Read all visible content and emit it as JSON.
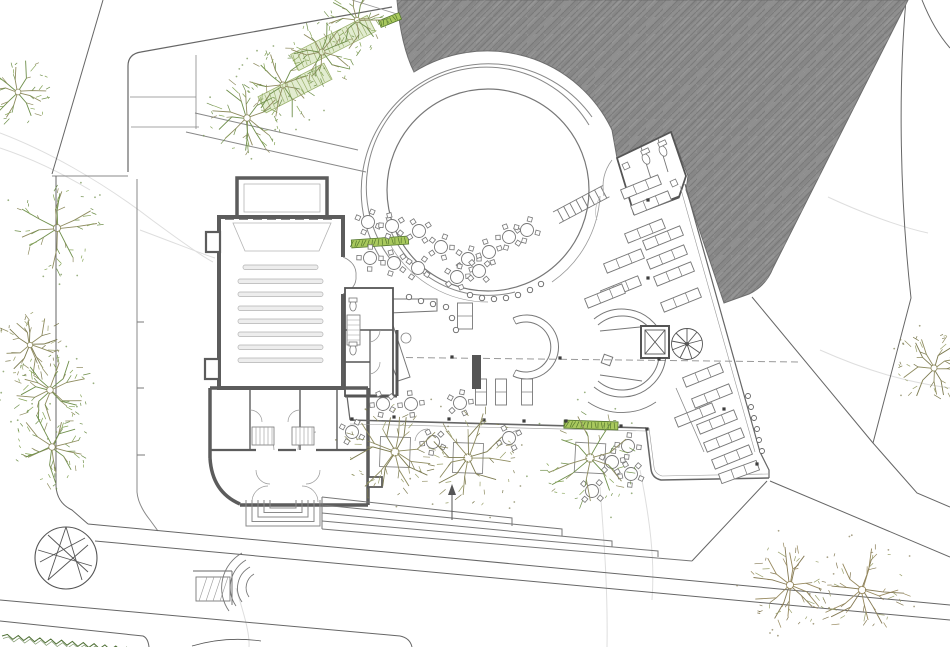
{
  "meta": {
    "kind": "architectural-site-plan",
    "description": "Ground floor plan drawing of a cultural building with circular courtyard, auditorium, library wing, cafe terrace and landscaped site",
    "canvas": {
      "width": 950,
      "height": 647
    }
  },
  "palette": {
    "paper": "#ffffff",
    "roof_fill": "#8f8f8f",
    "roof_hatch": "#7b7b7b",
    "roof_hatch2": "#9d9d9d",
    "wall_dark": "#5c5c5c",
    "wall_mid": "#6f6f6f",
    "line": "#888888",
    "line_light": "#aaaaaa",
    "faint": "#dedede",
    "site": "#7a7a7a",
    "green_bright": "#a9c95e",
    "green_dark": "#55772e",
    "green_pale": "#e2ecd0",
    "green_pale_stroke": "#9cb26e",
    "tree_olive": "#8f8c60",
    "tree_olive2": "#7c7a50",
    "tree_green": "#6f8f4b",
    "tree_green2": "#86a457",
    "tree_brown": "#97895e",
    "tree_brown2": "#857a55",
    "seat_fill": "#ededed",
    "seat_stroke": "#b3b3b3",
    "hedge": "#4f7035",
    "dot": "#3d3d3d"
  },
  "plan": {
    "trees": [
      {
        "x": 18,
        "y": 92,
        "r": 32,
        "kind": "green"
      },
      {
        "x": 57,
        "y": 228,
        "r": 40,
        "kind": "green"
      },
      {
        "x": 30,
        "y": 345,
        "r": 30,
        "kind": "olive"
      },
      {
        "x": 50,
        "y": 390,
        "r": 36,
        "kind": "green"
      },
      {
        "x": 52,
        "y": 447,
        "r": 36,
        "kind": "green"
      },
      {
        "x": 247,
        "y": 118,
        "r": 36,
        "kind": "green"
      },
      {
        "x": 283,
        "y": 85,
        "r": 34,
        "kind": "green"
      },
      {
        "x": 322,
        "y": 52,
        "r": 33,
        "kind": "green"
      },
      {
        "x": 357,
        "y": 20,
        "r": 30,
        "kind": "green"
      },
      {
        "x": 395,
        "y": 452,
        "r": 45,
        "kind": "olive"
      },
      {
        "x": 468,
        "y": 458,
        "r": 47,
        "kind": "olive"
      },
      {
        "x": 590,
        "y": 458,
        "r": 47,
        "kind": "green"
      },
      {
        "x": 790,
        "y": 585,
        "r": 40,
        "kind": "brown"
      },
      {
        "x": 862,
        "y": 590,
        "r": 42,
        "kind": "brown"
      },
      {
        "x": 934,
        "y": 368,
        "r": 34,
        "kind": "olive"
      }
    ],
    "planters": [
      {
        "x": 395,
        "y": 452,
        "s": 30,
        "a": 2
      },
      {
        "x": 468,
        "y": 458,
        "s": 30,
        "a": 2
      },
      {
        "x": 590,
        "y": 458,
        "s": 30,
        "a": 3
      }
    ],
    "tables": [
      [
        368,
        222
      ],
      [
        392,
        226
      ],
      [
        419,
        231
      ],
      [
        441,
        247
      ],
      [
        370,
        258
      ],
      [
        394,
        263
      ],
      [
        418,
        268
      ],
      [
        468,
        259
      ],
      [
        489,
        252
      ],
      [
        509,
        237
      ],
      [
        527,
        230
      ],
      [
        457,
        277
      ],
      [
        479,
        271
      ],
      [
        383,
        404
      ],
      [
        411,
        404
      ],
      [
        460,
        403
      ],
      [
        352,
        432
      ],
      [
        433,
        442
      ],
      [
        509,
        438
      ],
      [
        612,
        462
      ],
      [
        628,
        446
      ],
      [
        631,
        474
      ],
      [
        592,
        491
      ]
    ],
    "shelves": [
      [
        641,
        187,
        -22
      ],
      [
        651,
        203,
        -22
      ],
      [
        645,
        231,
        -22
      ],
      [
        663,
        238,
        -22
      ],
      [
        624,
        261,
        -22
      ],
      [
        667,
        257,
        -22
      ],
      [
        621,
        288,
        -22
      ],
      [
        674,
        274,
        -22
      ],
      [
        681,
        300,
        -22
      ],
      [
        605,
        296,
        -22
      ],
      [
        703,
        375,
        -22
      ],
      [
        712,
        396,
        -22
      ],
      [
        695,
        415,
        -22
      ],
      [
        717,
        422,
        -22
      ],
      [
        724,
        440,
        -22
      ],
      [
        732,
        457,
        -22
      ],
      [
        739,
        472,
        -20
      ]
    ],
    "stands": [
      [
        465,
        316,
        15,
        26
      ],
      [
        481,
        392,
        11,
        26
      ],
      [
        501,
        392,
        11,
        26
      ],
      [
        527,
        392,
        11,
        26
      ]
    ],
    "darkRect": {
      "x": 472,
      "y": 355,
      "w": 9,
      "h": 34
    },
    "columnDots": [
      [
        352,
        419
      ],
      [
        394,
        417
      ],
      [
        449,
        419
      ],
      [
        484,
        420
      ],
      [
        524,
        421
      ],
      [
        566,
        421
      ],
      [
        621,
        426
      ],
      [
        647,
        429
      ],
      [
        452,
        357
      ],
      [
        560,
        358
      ],
      [
        659,
        359
      ],
      [
        648,
        200
      ],
      [
        648,
        278
      ],
      [
        724,
        409
      ],
      [
        757,
        464
      ]
    ],
    "glassColumns": [
      [
        409,
        297
      ],
      [
        421,
        301
      ],
      [
        433,
        304
      ],
      [
        446,
        307
      ],
      [
        452,
        318
      ],
      [
        456,
        330
      ],
      [
        470,
        295
      ],
      [
        482,
        298
      ],
      [
        494,
        299
      ],
      [
        506,
        298
      ],
      [
        518,
        295
      ],
      [
        530,
        290
      ],
      [
        541,
        284
      ]
    ],
    "facadeColumns": [
      [
        748,
        396
      ],
      [
        751,
        407
      ],
      [
        754,
        418
      ],
      [
        757,
        429
      ],
      [
        759,
        440
      ],
      [
        762,
        451
      ]
    ],
    "greenStrips": [
      {
        "x": 380,
        "y": 242,
        "w": 57,
        "h": 8,
        "a": -4
      },
      {
        "x": 591,
        "y": 425,
        "w": 54,
        "h": 8,
        "a": 2
      },
      {
        "x": 390,
        "y": 20,
        "w": 22,
        "h": 7,
        "a": -22
      }
    ],
    "bandStrips": [
      {
        "x": 295,
        "y": 88,
        "w": 74,
        "h": 18,
        "a": -27
      },
      {
        "x": 333,
        "y": 43,
        "w": 86,
        "h": 18,
        "a": -27
      }
    ],
    "seatRows": {
      "ys": [
        265,
        279,
        292,
        306,
        319,
        332,
        345,
        358
      ],
      "x1": 238,
      "x2": 323,
      "firstX1": 243,
      "firstX2": 318,
      "h": 4.5
    },
    "chordCircle": {
      "x": 66,
      "y": 558,
      "r": 31,
      "chords": [
        [
          48,
          535,
          88,
          572
        ],
        [
          40,
          562,
          85,
          538
        ],
        [
          66,
          527,
          82,
          580
        ],
        [
          66,
          527,
          48,
          580
        ],
        [
          38,
          550,
          92,
          566
        ],
        [
          48,
          580,
          88,
          545
        ]
      ]
    },
    "hedge": {
      "x1": 2,
      "y1": 636,
      "x2": 132,
      "y2": 650,
      "segments": 24,
      "amp": 2.2
    }
  }
}
